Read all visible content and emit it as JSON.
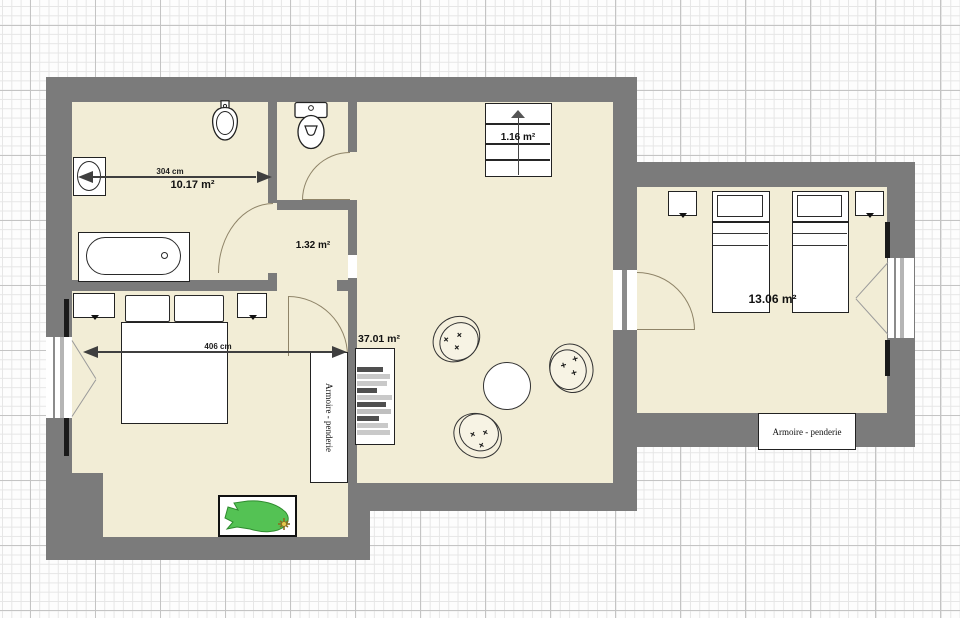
{
  "plan_labels": {
    "bathroom_area": "10.17 m²",
    "bathroom_dim": "304 cm",
    "closet_area": "1.32 m²",
    "stairs_area": "1.16 m²",
    "living_area": "37.01 m²",
    "bedroom_left_dim": "406 cm",
    "bedroom_right_area": "13.06 m²",
    "wardrobe_left": "Armoire - penderie",
    "wardrobe_right": "Armoire - penderie"
  },
  "colors": {
    "wall": "#7b7b7b",
    "floor": "#f2edd6",
    "grid_fine": "#e6e6e6",
    "grid_major": "#c4c4c4",
    "plant_green": "#54c254",
    "flower_yellow": "#e6c94c"
  }
}
